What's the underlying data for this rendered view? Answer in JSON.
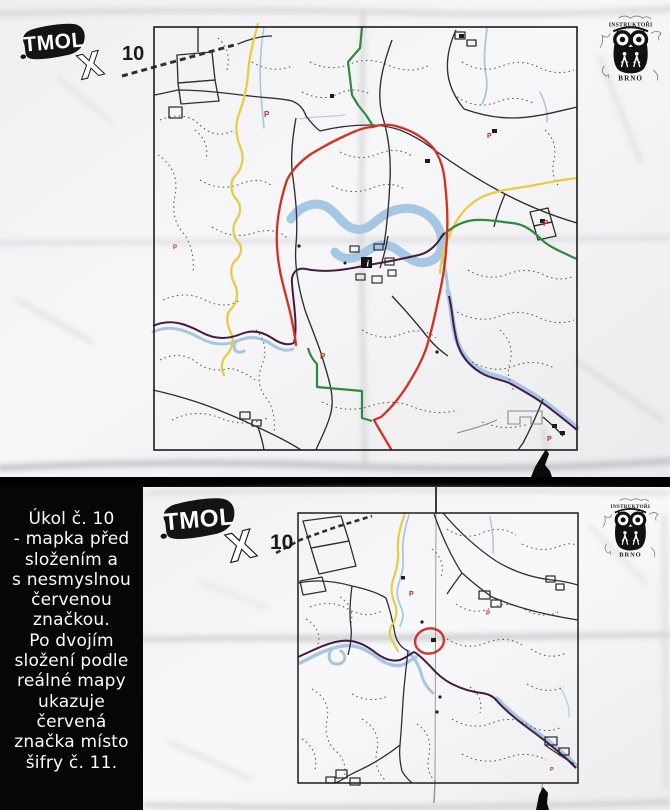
{
  "colors": {
    "paper": "#f3f3f5",
    "map_ink": "#2f2f2f",
    "route_red": "#d52f1f",
    "trail_yellow": "#e9cb45",
    "trail_green": "#2e8b3c",
    "trail_purple": "#451b44",
    "water_blue": "#a6c7e4",
    "mark_red": "#c62a1c"
  },
  "logo": {
    "title": "TMOL",
    "suffix": "X",
    "map_number": "10"
  },
  "publisher": {
    "arc_text": "INSTRUKTOŘI",
    "name": "BRNO"
  },
  "map_symbols": {
    "parking": "P",
    "info": "i"
  },
  "task_panel": {
    "lines": [
      "Úkol č. 10",
      "- mapka před",
      "složením a",
      "s nesmyslnou",
      "červenou",
      "značkou.",
      "Po dvojím",
      "složení podle",
      "reálné mapy",
      "ukazuje",
      "červená",
      "značka místo",
      "šifry č. 11."
    ]
  }
}
